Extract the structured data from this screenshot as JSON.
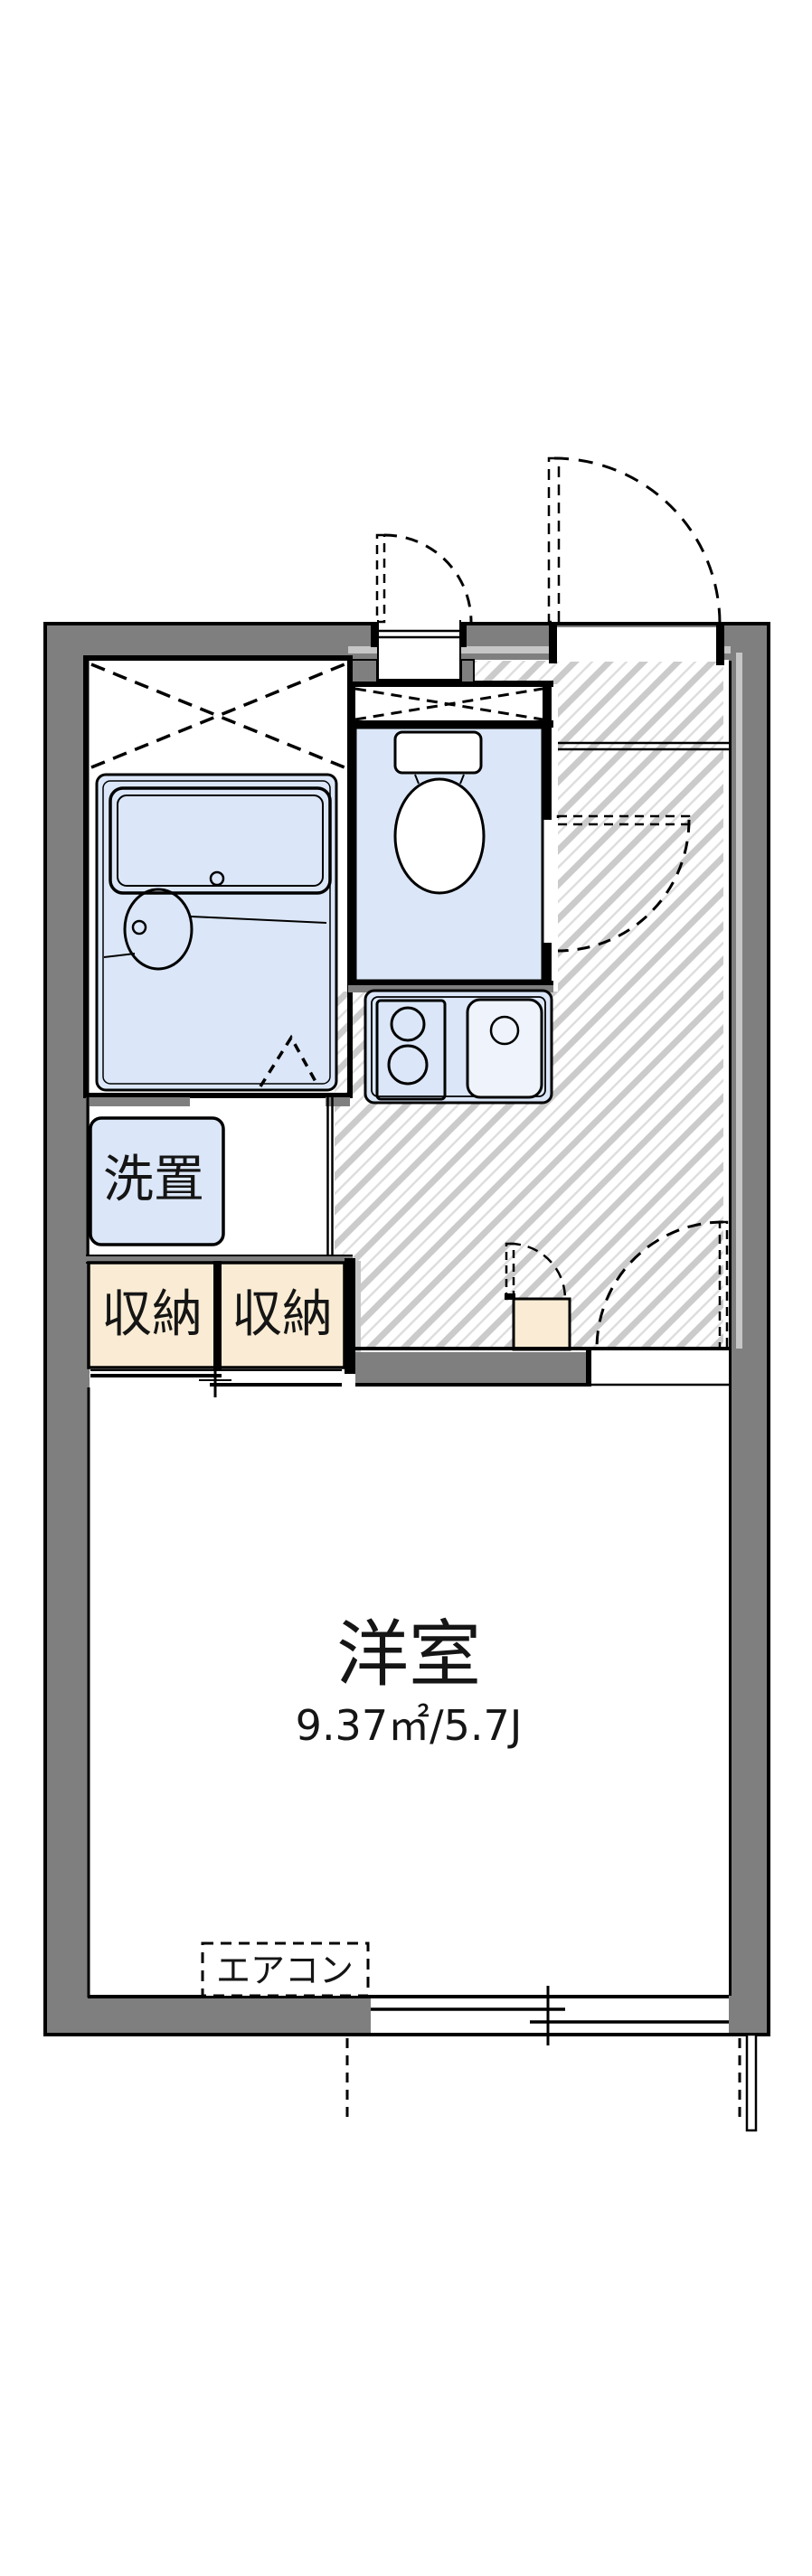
{
  "document_title": "apartment-floor-plan",
  "labels": {
    "main_room": "洋室",
    "main_room_area": "9.37㎡/5.7J",
    "closet_left": "収納",
    "closet_right": "収納",
    "washer_space": "洗置",
    "air_conditioner": "エアコン"
  },
  "colors": {
    "wall_gray": "#7f7f7f",
    "fixture_blue": "#dbe7f8",
    "closet_beige": "#faecd4",
    "hatch_gray": "#cbcbcb",
    "boundary_silver": "#c6c6c6",
    "line_black": "#000000",
    "background": "#ffffff"
  }
}
